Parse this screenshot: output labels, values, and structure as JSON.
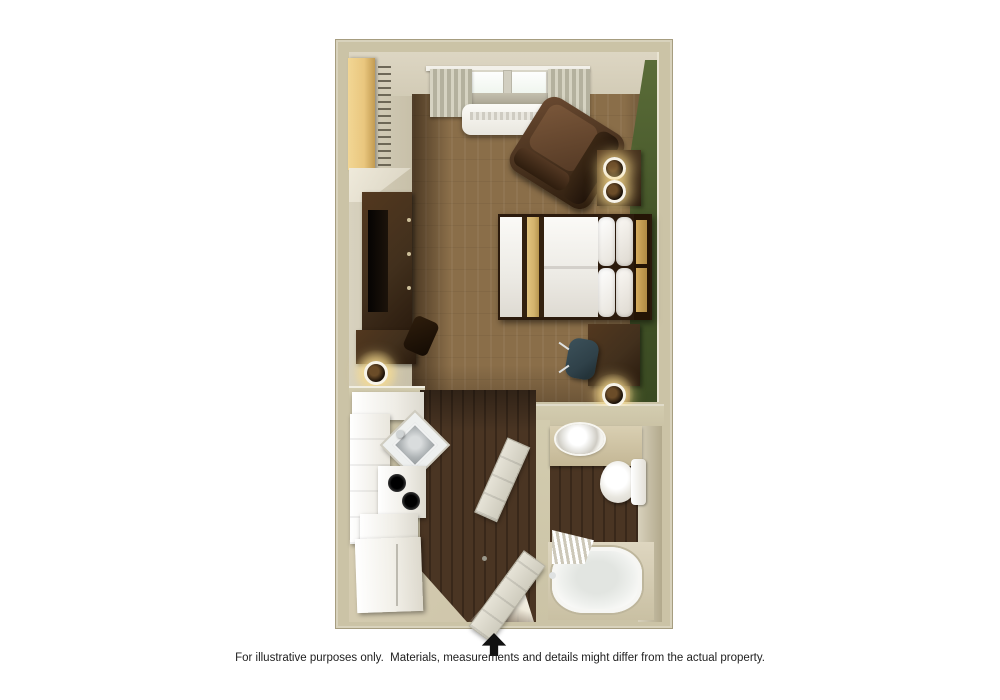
{
  "caption": {
    "text": "For illustrative purposes only.  Materials, measurements and details might differ from the actual property."
  },
  "entrance_arrow": {
    "icon": "up-arrow-icon"
  },
  "palette": {
    "wall": "#cbc3a6",
    "wall-edge": "#a69d80",
    "carpet": "#8a6e49",
    "green-dark": "#3a4a22",
    "dark-wood": "#42301d",
    "darker-wood": "#2a1b0e",
    "closet-wood": "#e9c67e",
    "tan-runner": "#d2b26c",
    "floor-wood": "#4a3523",
    "floor-wood-dark": "#39281a",
    "tile": "#cfc6ab",
    "chair-teal": "#2f4149",
    "arrow": "#111111",
    "text": "#1e1e1e"
  },
  "floorplan": {
    "type": "studio-suite-3d-top-view",
    "rooms": [
      {
        "name": "bedroom-living",
        "floor": "carpet",
        "features": [
          "closet",
          "hanger-rod",
          "window",
          "curtains",
          "ptac-ac-unit",
          "armchair",
          "side-table-with-two-lamps",
          "queen-bed",
          "tv-console",
          "tv",
          "counter-desk-run",
          "pulled-chair",
          "floor-lamp",
          "desk",
          "desk-chair",
          "green-accent-wall"
        ]
      },
      {
        "name": "kitchen",
        "floor": "wood-and-tile",
        "features": [
          "upper-counter",
          "corner-sink",
          "faucet",
          "two-burner-stove",
          "base-cabinets",
          "refrigerator"
        ]
      },
      {
        "name": "entry-hall",
        "floor": "wood",
        "features": [
          "entry-door-open",
          "bathroom-door-open",
          "threshold-light"
        ]
      },
      {
        "name": "bathroom",
        "floor": "wood",
        "features": [
          "vanity-counter",
          "round-sink",
          "toilet",
          "bathtub",
          "shower-curtain"
        ]
      }
    ]
  }
}
